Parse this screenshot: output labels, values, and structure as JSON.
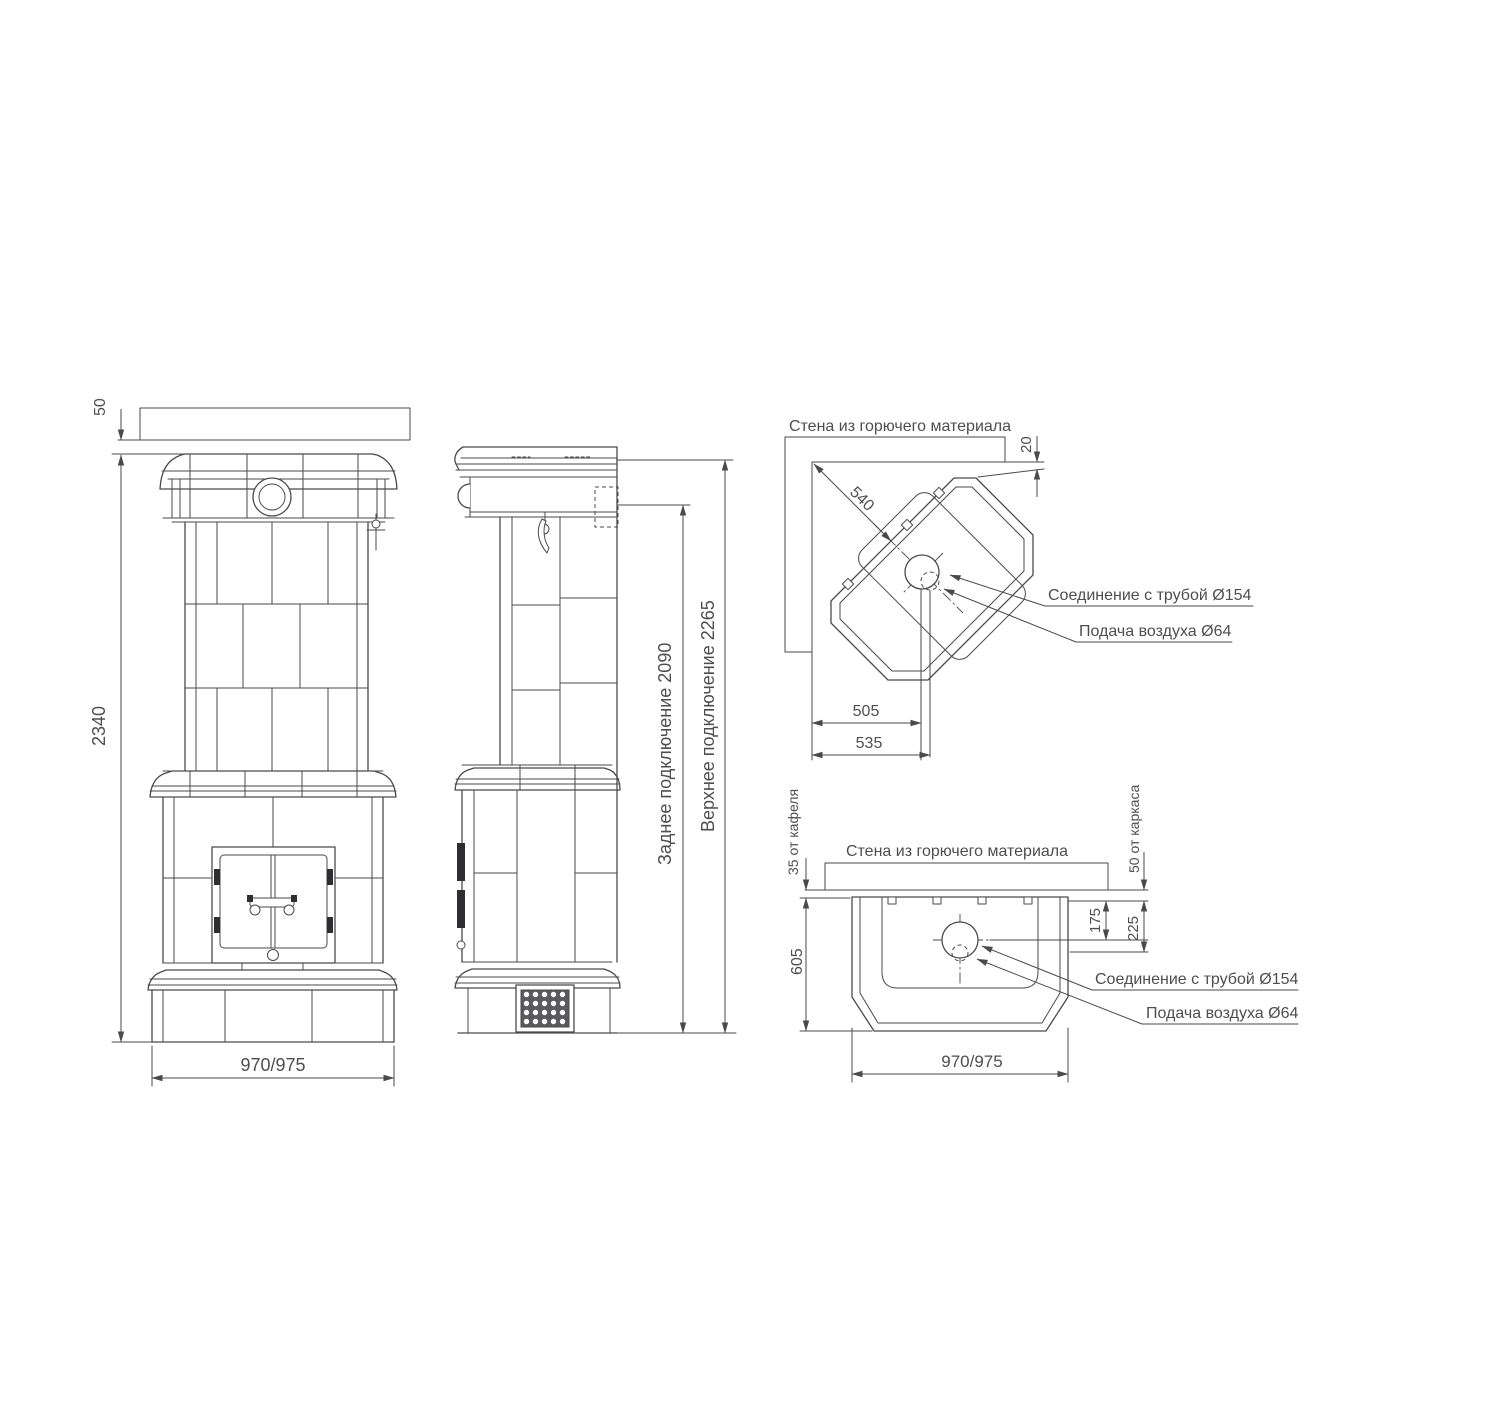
{
  "drawing": {
    "front": {
      "ceiling_gap": "50",
      "total_height": "2340",
      "width": "970/975"
    },
    "side": {
      "rear_connection": "Заднее подключение 2090",
      "top_connection": "Верхнее подключение 2265"
    },
    "corner": {
      "wall_label": "Стена из горючего материала",
      "back_clearance": "540",
      "wall_gap": "20",
      "to_flue_axis": "505",
      "to_air_axis": "535",
      "flue_label": "Соединение с трубой Ø154",
      "air_label": "Подача воздуха Ø64"
    },
    "plan": {
      "wall_label": "Стена из горючего материала",
      "tile_gap": "35 от кафеля",
      "frame_gap": "50 от каркаса",
      "depth": "605",
      "flue_offset": "175",
      "air_offset": "225",
      "width": "970/975",
      "flue_label": "Соединение с трубой Ø154",
      "air_label": "Подача воздуха Ø64"
    }
  }
}
